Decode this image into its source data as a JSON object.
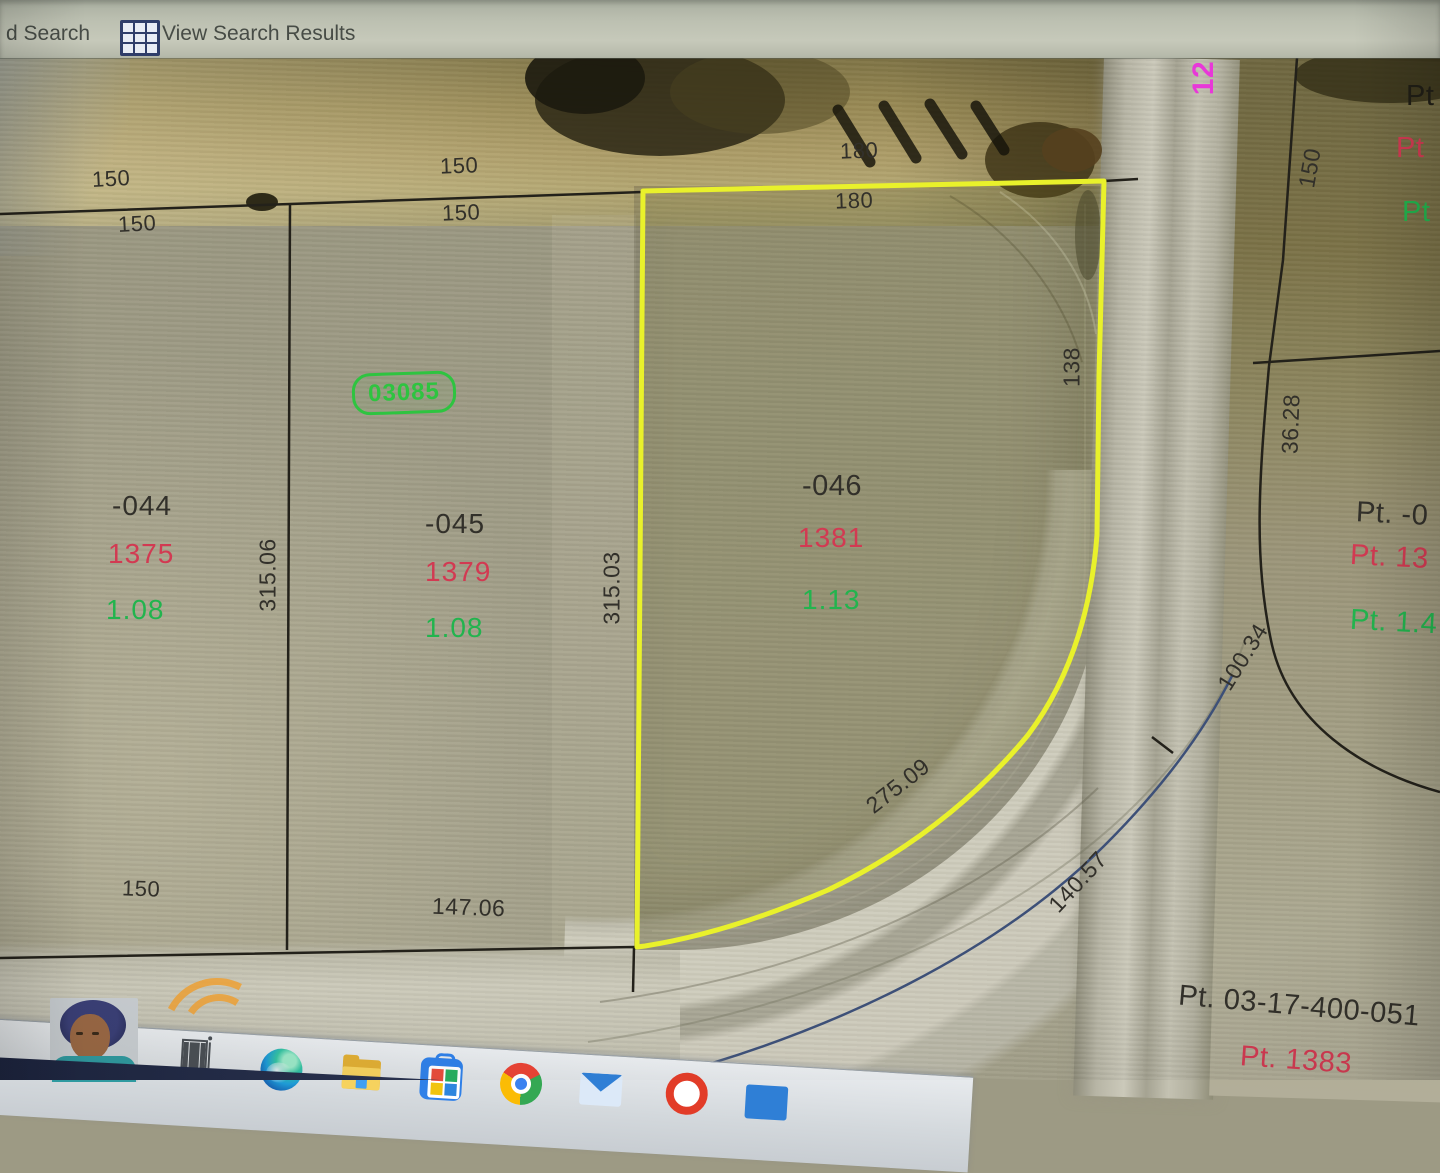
{
  "toolbar": {
    "partial_search_label": "d Search",
    "view_results_label": "View Search Results",
    "icons": [
      "results-grid-icon"
    ]
  },
  "map": {
    "region_tag": "03085",
    "road_tag_magenta": "12",
    "parcels": [
      {
        "number": "-044",
        "parcel_id": "1375",
        "acres": "1.08"
      },
      {
        "number": "-045",
        "parcel_id": "1379",
        "acres": "1.08"
      },
      {
        "number": "-046",
        "parcel_id": "1381",
        "acres": "1.13",
        "highlighted": true
      }
    ],
    "dims": {
      "w150": "150",
      "w180": "180",
      "l31506": "315.06",
      "l31503": "315.03",
      "l138": "138",
      "l3628": "36.28",
      "l10034": "100.34",
      "l27509": "275.09",
      "l14057": "140.57",
      "l14706": "147.06"
    },
    "neighbors": {
      "pt": "Pt",
      "right_black": "Pt. -0",
      "right_red": "Pt. 13",
      "right_green": "Pt. 1.4",
      "bottom_black": "Pt. 03-17-400-051",
      "bottom_red": "Pt. 1383"
    },
    "colors": {
      "highlight_outline": "#e9f12b",
      "parcel_id_red": "#d23a52",
      "acres_green": "#22b44e",
      "region_tag_green": "#2ec440",
      "road_tag_magenta": "#e838d8"
    }
  },
  "taskbar": {
    "icons": [
      "task-view",
      "edge",
      "file-explorer",
      "microsoft-store",
      "chrome",
      "mail",
      "browser-partial",
      "window-partial"
    ]
  }
}
